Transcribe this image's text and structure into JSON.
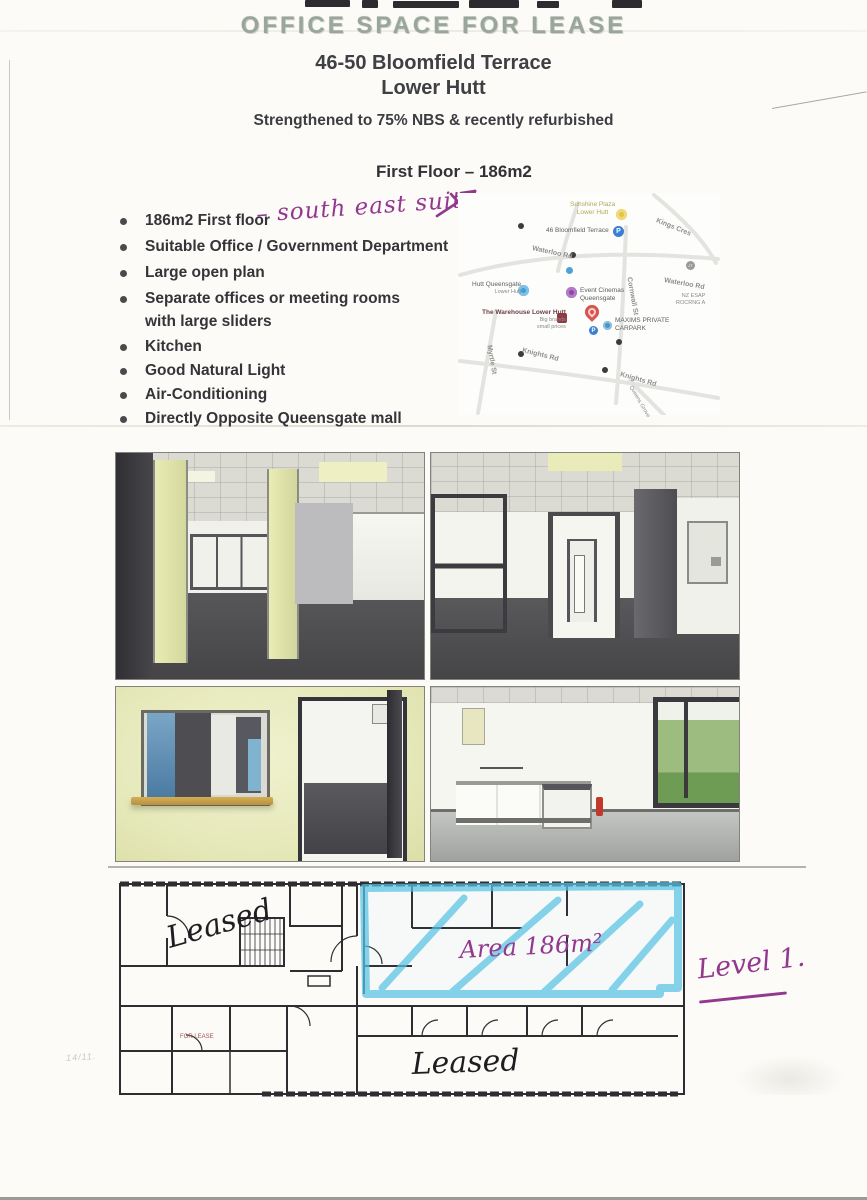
{
  "header": {
    "stamp_title": "OFFICE SPACE FOR LEASE",
    "address_line1": "46-50 Bloomfield Terrace",
    "address_line2": "Lower Hutt",
    "strength_note": "Strengthened to 75% NBS & recently refurbished",
    "section_title": "First Floor – 186m2"
  },
  "features": [
    {
      "text": "186m2 First floor"
    },
    {
      "text": "Suitable Office / Government Department"
    },
    {
      "text": "Large open plan"
    },
    {
      "text": "Separate offices or meeting rooms",
      "text2": "with large sliders"
    },
    {
      "text": "Kitchen"
    },
    {
      "text": "Good Natural Light"
    },
    {
      "text": "Air-Conditioning"
    },
    {
      "text": "Directly Opposite Queensgate mall"
    }
  ],
  "handwritten": {
    "suite_note": "– south east suite",
    "area_note": "Area 186m²",
    "level_note": "Level 1.",
    "leased_upper": "Leased",
    "leased_lower": "Leased",
    "faint_note": "14/11."
  },
  "floor_plan": {
    "for_lease_label": "FOR LEASE"
  },
  "map": {
    "sunshine_1": "Sunshine Plaza",
    "sunshine_2": "Lower Hutt",
    "bloomfield": "46 Bloomfield Terrace",
    "kings_cres": "Kings Cres",
    "waterloo_1": "Waterloo Rd",
    "waterloo_2": "Waterloo Rd",
    "queensgate_1": "Hutt Queensgate",
    "queensgate_2": "Lower Hutt",
    "event_1": "Event Cinemas",
    "event_2": "Queensgate",
    "cornwall": "Cornwall St",
    "nz_1": "NZ ESAP",
    "nz_2": "ROCRNG A",
    "warehouse_1": "The Warehouse Lower Hutt",
    "warehouse_2": "Big brands",
    "warehouse_3": "small prices",
    "maxims_1": "MAXIMS PRIVATE",
    "maxims_2": "CARPARK",
    "knights_1": "Knights Rd",
    "knights_2": "Knights Rd",
    "myrtle": "Myrtle St",
    "queens_grove": "Queens Grove",
    "jt": "JT"
  },
  "colors": {
    "stamp_ink": "#9ba69b",
    "body_ink": "#353539",
    "purple_pen": "#93388f",
    "blue_highlighter": "#57c3e5",
    "leased_ink": "#1e1e21",
    "for_lease_red": "#a0524a"
  }
}
